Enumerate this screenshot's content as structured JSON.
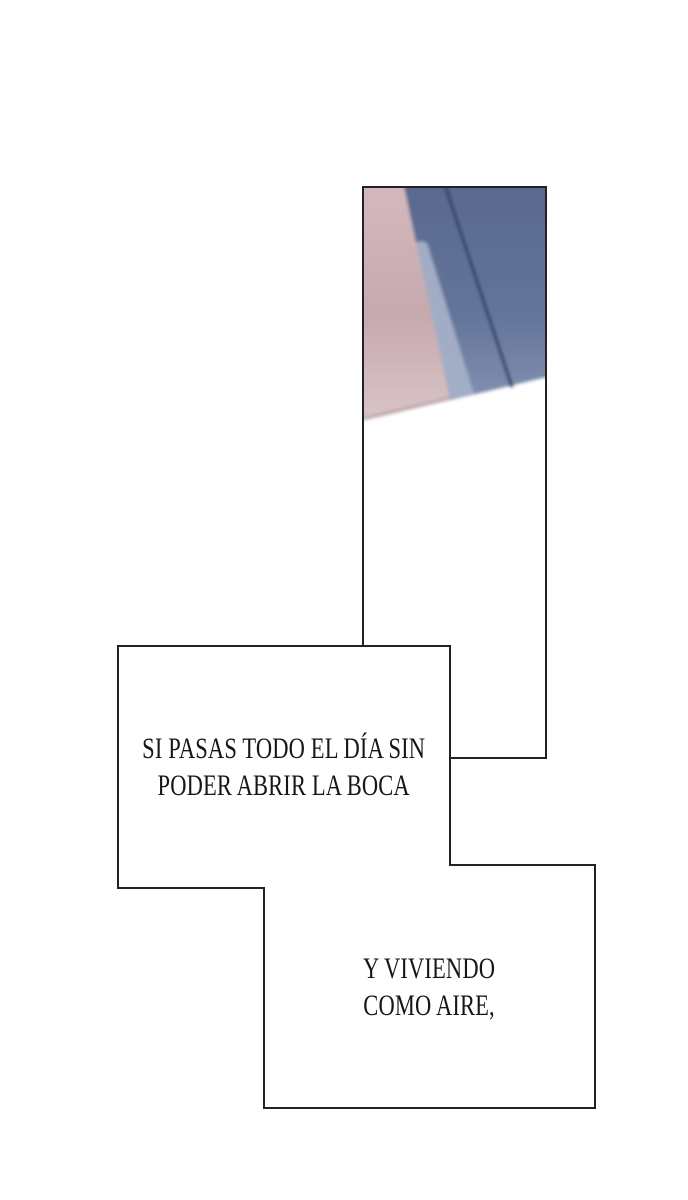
{
  "page": {
    "background_color": "#ffffff",
    "panel_border_color": "#222222",
    "text_color": "#161616"
  },
  "artwork_panel": {
    "colors": {
      "pink_top": "#d3b9bd",
      "pink_mid": "#c7a9ae",
      "pink_bottom": "#d8c5c7",
      "blue_top": "#59698f",
      "blue_mid": "#64749b",
      "blue_bottom": "#8997b5",
      "light_band": "#a4afc7",
      "dark_diagonal_line": "#36466a",
      "pink_edge_line": "#b89aa0"
    }
  },
  "speech_boxes": [
    {
      "lines": [
        "SI PASAS TODO EL DÍA SIN",
        "PODER ABRIR LA BOCA"
      ]
    },
    {
      "lines": [
        "Y VIVIENDO",
        "COMO AIRE,"
      ]
    }
  ]
}
